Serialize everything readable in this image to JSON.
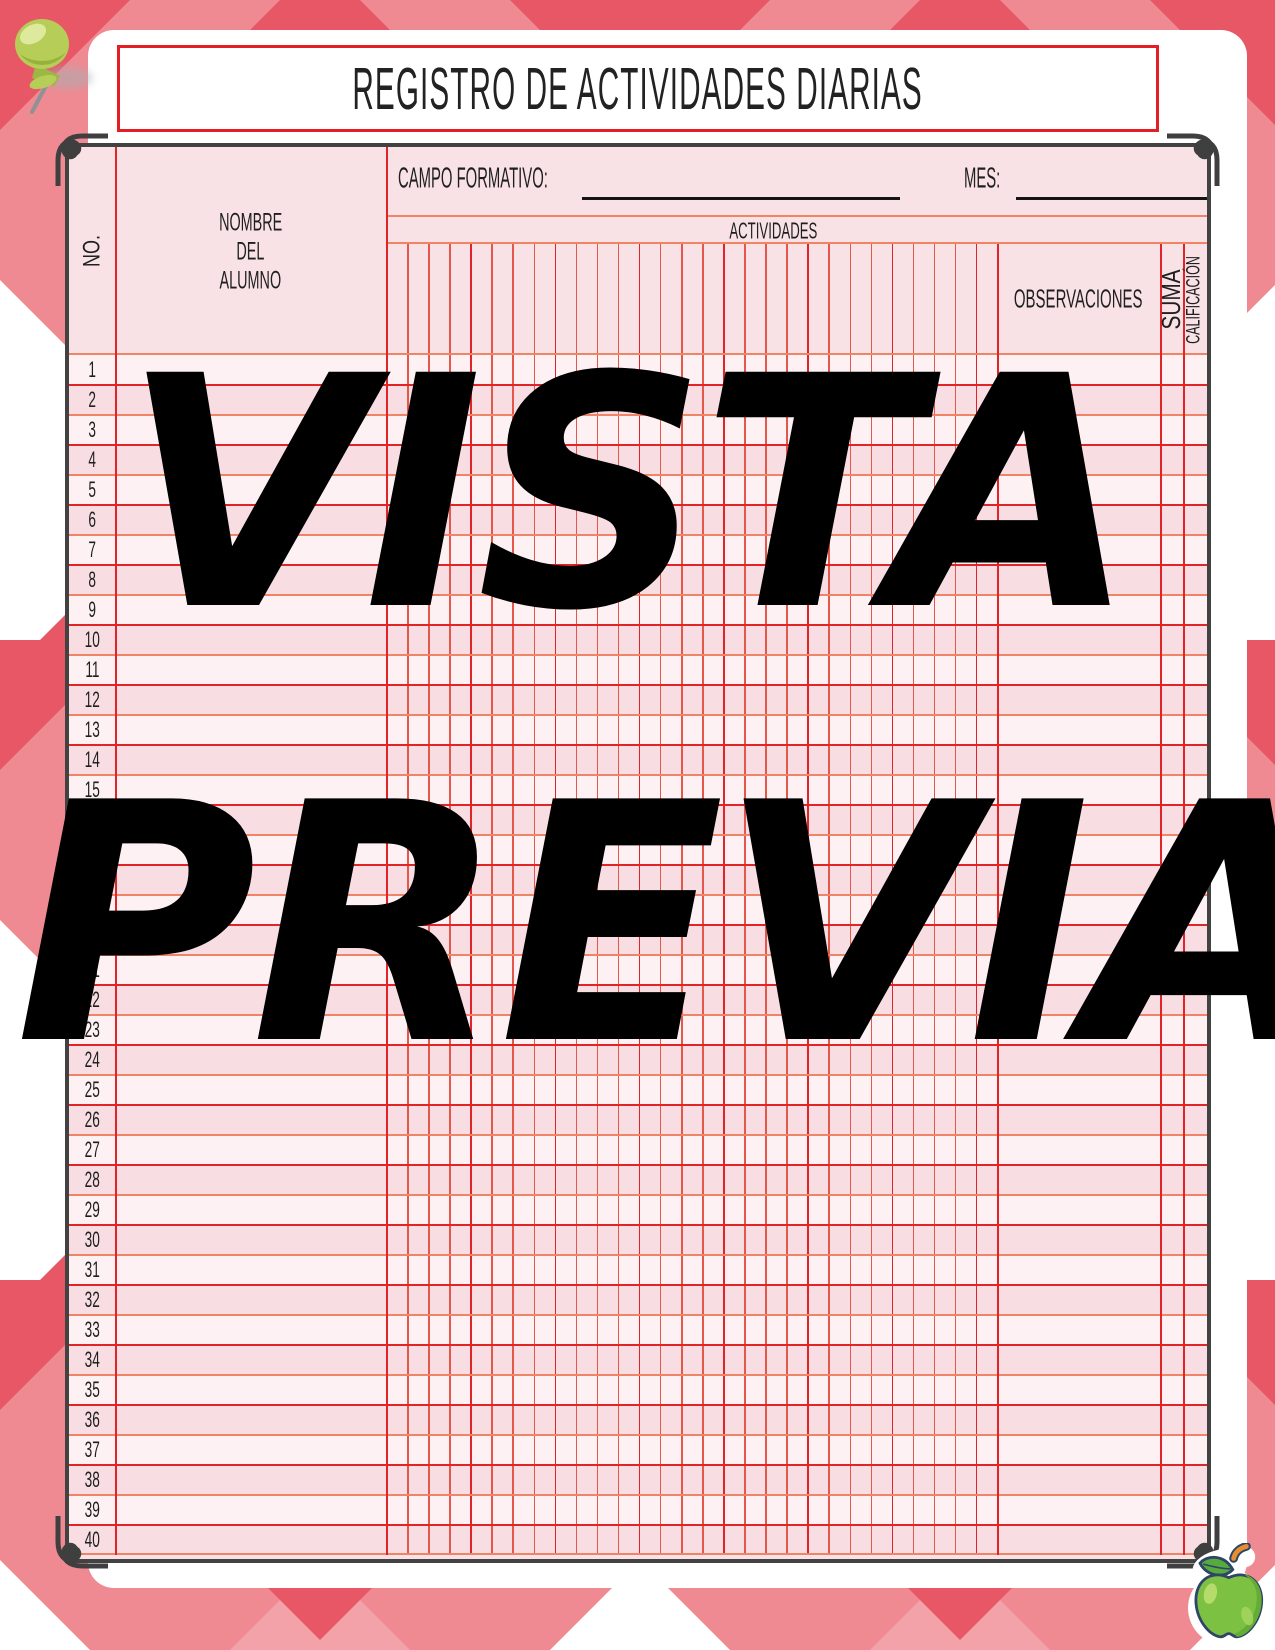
{
  "page": {
    "title": "REGISTRO DE ACTIVIDADES DIARIAS",
    "watermark": {
      "line1": "VISTA",
      "line2": "PREVIA"
    }
  },
  "table": {
    "fields": {
      "campo_formativo_label": "CAMPO FORMATIVO:",
      "campo_formativo_value": "",
      "mes_label": "MES:",
      "mes_value": ""
    },
    "columns": {
      "no": "NO.",
      "nombre": [
        "NOMBRE",
        "DEL",
        "ALUMNO"
      ],
      "actividades": "ACTIVIDADES",
      "observaciones": "OBSERVACIONES",
      "suma": "SUMA",
      "calificacion": "CALIFICACIÓN"
    },
    "activity_column_count": 29,
    "row_count": 40,
    "row_numbers": [
      1,
      2,
      3,
      4,
      5,
      6,
      7,
      8,
      9,
      10,
      11,
      12,
      13,
      14,
      15,
      16,
      17,
      18,
      19,
      20,
      21,
      22,
      23,
      24,
      25,
      26,
      27,
      28,
      29,
      30,
      31,
      32,
      33,
      34,
      35,
      36,
      37,
      38,
      39,
      40
    ]
  },
  "icons": {
    "push_pin": "push-pin-icon",
    "apple": "green-apple-icon",
    "corner_flourish": "corner-flourish-icon"
  },
  "colors": {
    "pattern_salmon": "#ef8a92",
    "pattern_dark_red": "#e85765",
    "pattern_light_salmon": "#f4a2a9",
    "pattern_white": "#ffffff",
    "title_border_red": "#e31e24",
    "frame_gray": "#424242",
    "grid_red": "#e02428",
    "grid_soft_red": "#e4584b",
    "grid_orange": "#f08466",
    "row_light_pink": "#fdf1f3",
    "row_dark_pink": "#f8dee3",
    "header_pink": "#f9e2e5",
    "watermark_black": "#000000"
  }
}
